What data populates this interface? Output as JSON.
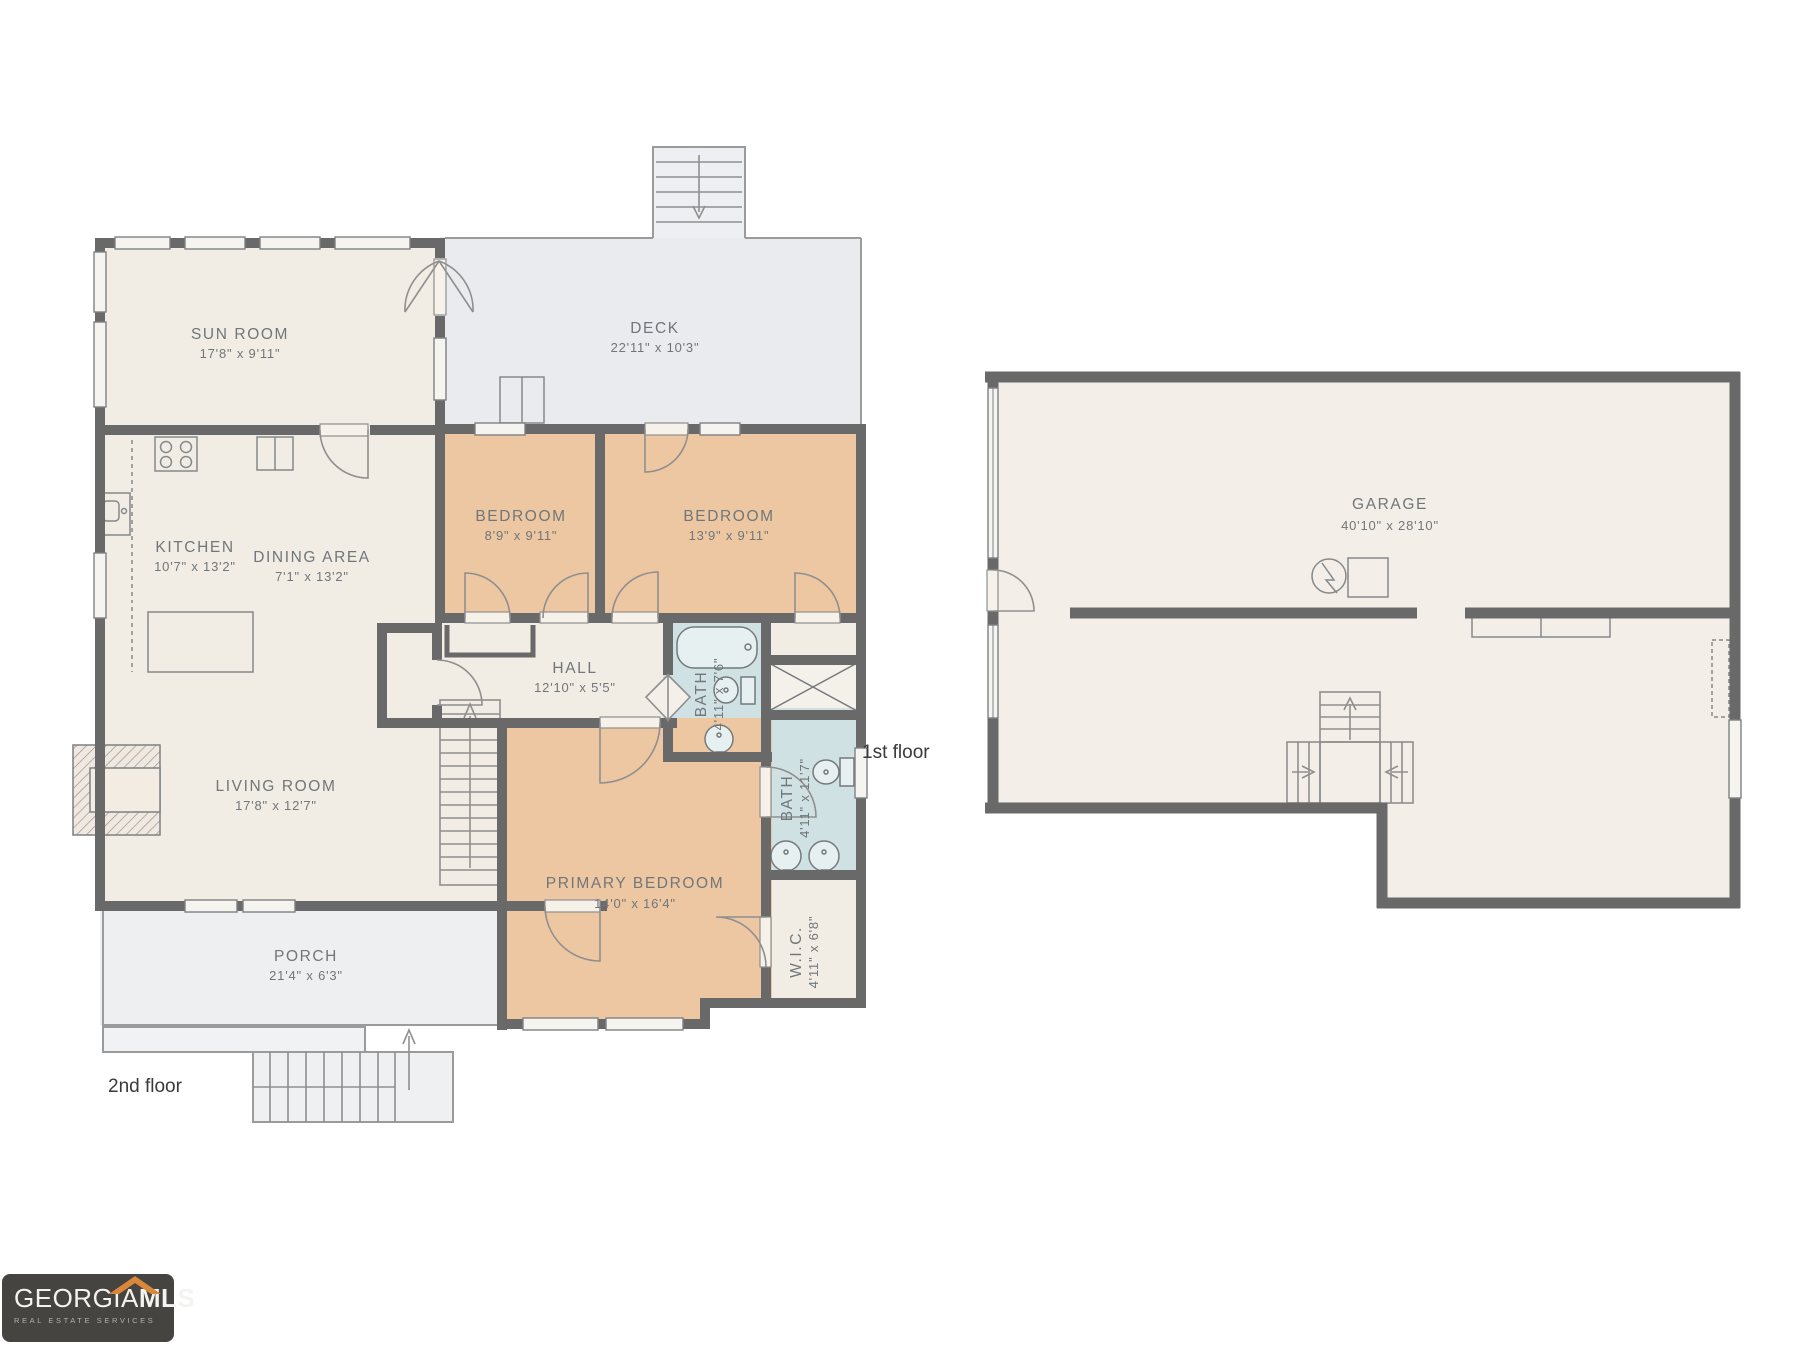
{
  "colors": {
    "wall": "#696969",
    "thin_line": "#9b9b9b",
    "room_beige": "#f2ede4",
    "room_peach": "#edc7a2",
    "room_blue": "#cfe1e2",
    "deck_gray": "#e9ebee",
    "porch_gray": "#edeff1",
    "garage_beige": "#f3eee8",
    "label_text": "#70767a",
    "logo_bg": "#454441",
    "logo_accent": "#d9873a"
  },
  "floors": {
    "second": {
      "caption": "2nd floor",
      "rooms": {
        "sun_room": {
          "name": "SUN ROOM",
          "dims": "17'8\" x 9'11\""
        },
        "deck": {
          "name": "DECK",
          "dims": "22'11\" x 10'3\""
        },
        "kitchen": {
          "name": "KITCHEN",
          "dims": "10'7\" x 13'2\""
        },
        "dining": {
          "name": "DINING AREA",
          "dims": "7'1\" x 13'2\""
        },
        "bedroom_small": {
          "name": "BEDROOM",
          "dims": "8'9\" x 9'11\""
        },
        "bedroom_mid": {
          "name": "BEDROOM",
          "dims": "13'9\" x 9'11\""
        },
        "hall": {
          "name": "HALL",
          "dims": "12'10\" x 5'5\""
        },
        "living": {
          "name": "LIVING ROOM",
          "dims": "17'8\" x 12'7\""
        },
        "bath_hall": {
          "name": "BATH",
          "dims": "4'11\" x 7'6\""
        },
        "bath_primary": {
          "name": "BATH",
          "dims": "4'11\" x 11'7\""
        },
        "wic": {
          "name": "W.I.C.",
          "dims": "4'11\" x 6'8\""
        },
        "primary": {
          "name": "PRIMARY BEDROOM",
          "dims": "14'0\" x 16'4\""
        },
        "porch": {
          "name": "PORCH",
          "dims": "21'4\" x 6'3\""
        }
      }
    },
    "first": {
      "caption": "1st floor",
      "rooms": {
        "garage": {
          "name": "GARAGE",
          "dims": "40'10\" x 28'10\""
        }
      }
    }
  },
  "logo": {
    "brand_primary": "GEORGIA",
    "brand_secondary": "MLS",
    "tagline": "REAL ESTATE SERVICES"
  }
}
